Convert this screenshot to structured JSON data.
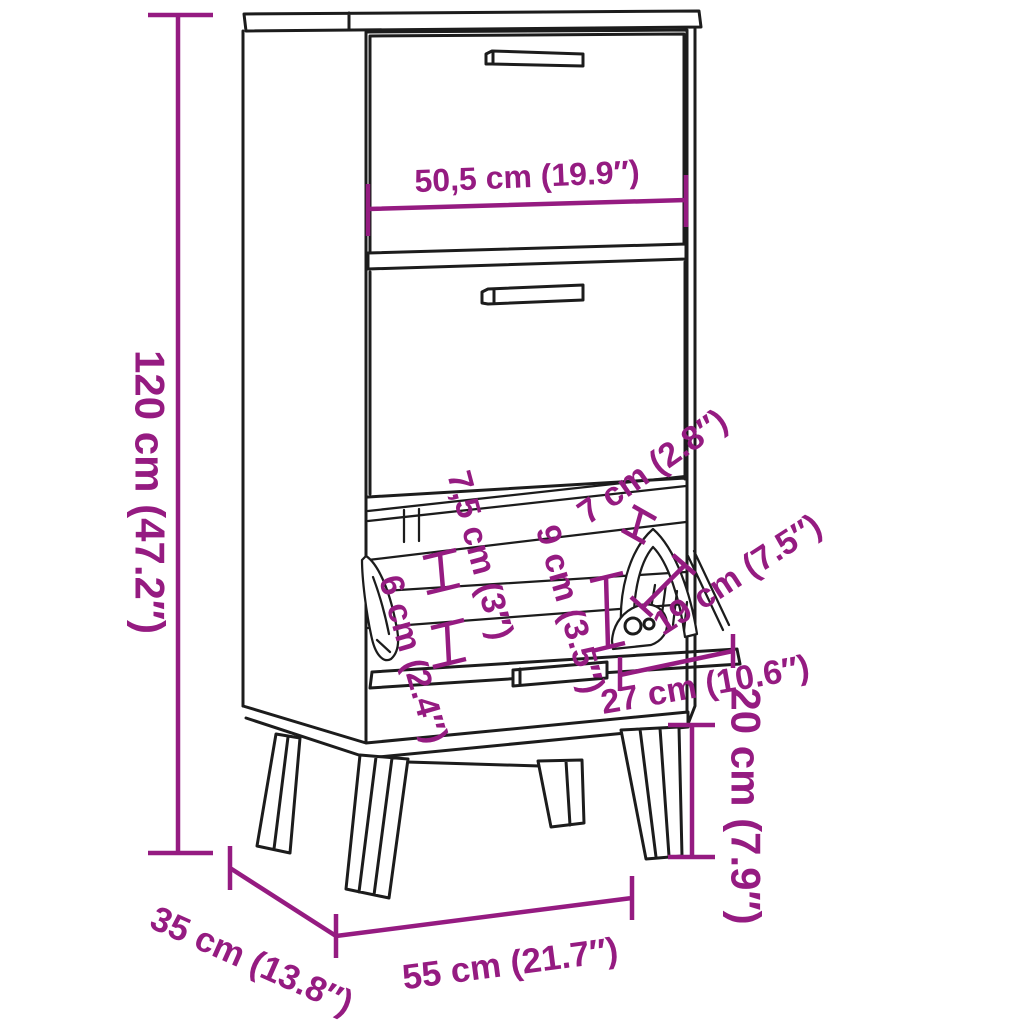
{
  "colors": {
    "dimension": "#951b81",
    "line": "#1c1c1c",
    "background": "#ffffff"
  },
  "dimensions": {
    "height": "120 cm (47.2″)",
    "flap_front_width": "50,5 cm (19.9″)",
    "top_gap": "7 cm (2.8″)",
    "upper_clearance": "7,5 cm (3″)",
    "inner_height": "9 cm (3.5″)",
    "lower_clearance": "6 cm (2.4″)",
    "flap_pocket_depth": "19 cm (7.5″)",
    "flap_opening_depth": "27 cm (10.6″)",
    "leg_height": "20 cm (7.9″)",
    "width": "55 cm (21.7″)",
    "depth": "35 cm (13.8″)"
  }
}
